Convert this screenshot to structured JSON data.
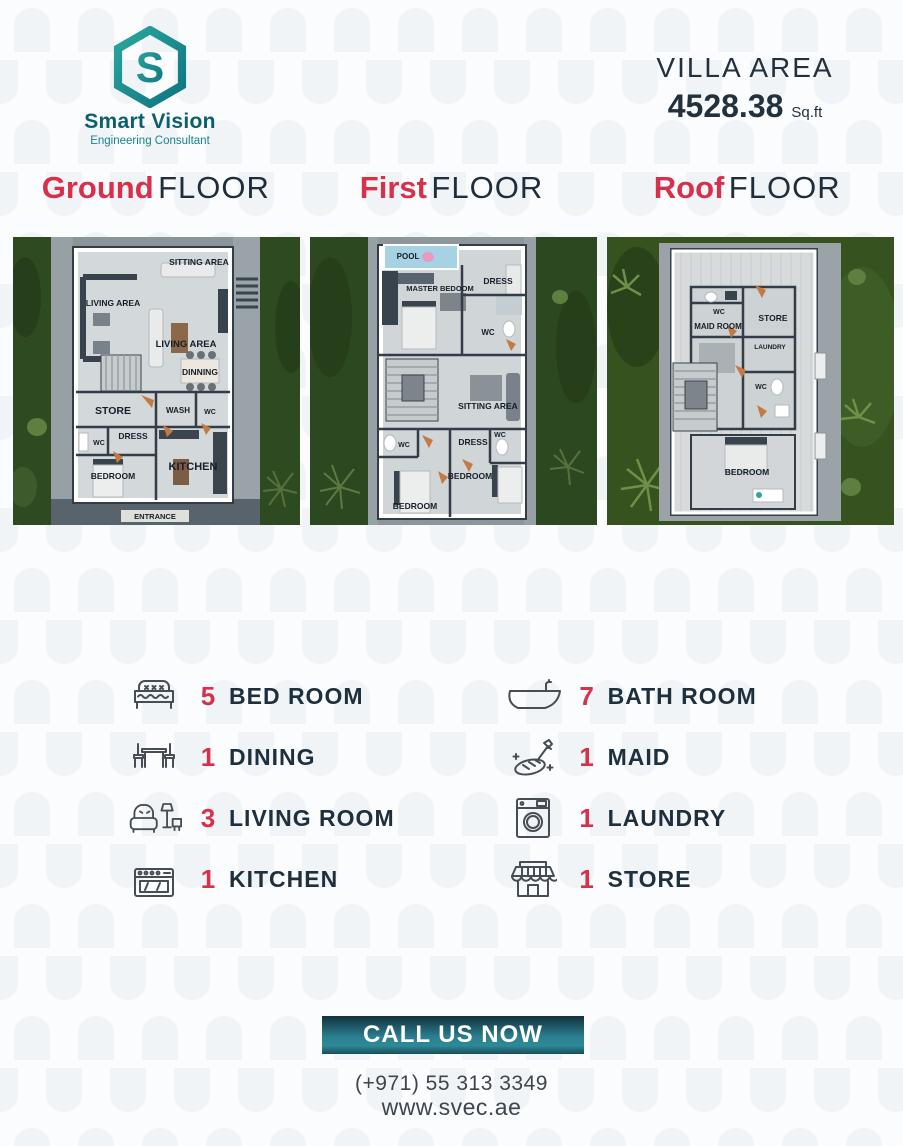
{
  "logo": {
    "name": "Smart Vision",
    "subtitle": "Engineering Consultant",
    "monogram": "S"
  },
  "villa_area": {
    "label": "VILLA AREA",
    "value": "4528.38",
    "unit": "Sq.ft"
  },
  "floors": [
    {
      "accent": "Ground",
      "rest": "FLOOR"
    },
    {
      "accent": "First",
      "rest": "FLOOR"
    },
    {
      "accent": "Roof",
      "rest": "FLOOR"
    }
  ],
  "plans": {
    "ground": {
      "rooms": [
        "SITTING AREA",
        "LIVING AREA",
        "LIVING AREA",
        "DINNING",
        "STORE",
        "WASH",
        "WC",
        "DRESS",
        "WC",
        "BEDROOM",
        "KITCHEN",
        "ENTRANCE"
      ]
    },
    "first": {
      "rooms": [
        "POOL",
        "MASTER BEDOOM",
        "DRESS",
        "WC",
        "SITTING AREA",
        "WC",
        "DRESS",
        "WC",
        "BEDROOM",
        "BEDROOM"
      ]
    },
    "roof": {
      "rooms": [
        "WC",
        "MAID ROOM",
        "STORE",
        "LAUNDRY",
        "WC",
        "BEDROOM"
      ]
    }
  },
  "features": {
    "left": [
      {
        "count": "5",
        "label": "BED ROOM",
        "icon": "bed-icon"
      },
      {
        "count": "1",
        "label": "DINING",
        "icon": "dining-table-icon"
      },
      {
        "count": "3",
        "label": "LIVING ROOM",
        "icon": "armchair-lamp-icon"
      },
      {
        "count": "1",
        "label": "KITCHEN",
        "icon": "stove-icon"
      }
    ],
    "right": [
      {
        "count": "7",
        "label": "BATH ROOM",
        "icon": "bathtub-icon"
      },
      {
        "count": "1",
        "label": "MAID",
        "icon": "cleaning-sponge-icon"
      },
      {
        "count": "1",
        "label": "LAUNDRY",
        "icon": "washing-machine-icon"
      },
      {
        "count": "1",
        "label": "STORE",
        "icon": "storefront-icon"
      }
    ]
  },
  "cta": {
    "button": "CALL US NOW",
    "phone": "(+971) 55 313 3349",
    "website": "www.svec.ae"
  },
  "colors": {
    "accent_red": "#d7304a",
    "navy": "#1f2e3a",
    "teal": "#2a7f8f",
    "logo_teal_dark": "#0b5f6d",
    "logo_teal_light": "#2aa79d"
  }
}
